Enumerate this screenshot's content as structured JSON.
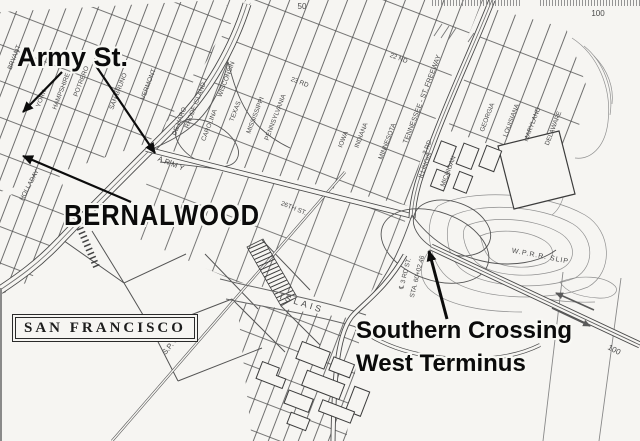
{
  "annotations": {
    "army_st": "Army St.",
    "bernalwood": "BERNALWOOD",
    "san_francisco": "SAN FRANCISCO",
    "southern_crossing_line1": "Southern Crossing",
    "southern_crossing_line2": "West Terminus"
  },
  "map": {
    "street_labels": [
      {
        "t": "BRYANT",
        "x": 16,
        "y": 58,
        "r": -69
      },
      {
        "t": "YORK",
        "x": 43,
        "y": 99,
        "r": -69
      },
      {
        "t": "HAMPSHIRE",
        "x": 63,
        "y": 92,
        "r": -69
      },
      {
        "t": "POTRERO",
        "x": 83,
        "y": 82,
        "r": -69
      },
      {
        "t": "SAN BRUNO",
        "x": 120,
        "y": 92,
        "r": -69
      },
      {
        "t": "VERMONT",
        "x": 150,
        "y": 85,
        "r": -69
      },
      {
        "t": "DE HARO",
        "x": 181,
        "y": 122,
        "r": -69
      },
      {
        "t": "RHODE ISLAND",
        "x": 197,
        "y": 106,
        "r": -69
      },
      {
        "t": "CAROLINA",
        "x": 211,
        "y": 126,
        "r": -69
      },
      {
        "t": "WISCONSIN",
        "x": 228,
        "y": 80,
        "r": -69
      },
      {
        "t": "HOLLADAY",
        "x": 31,
        "y": 186,
        "r": -62
      },
      {
        "t": "23 RD",
        "x": 299,
        "y": 84,
        "r": 21
      },
      {
        "t": "22 ND",
        "x": 398,
        "y": 60,
        "r": 21
      },
      {
        "t": "TEXAS",
        "x": 237,
        "y": 112,
        "r": -69
      },
      {
        "t": "MISSISSIPPI",
        "x": 257,
        "y": 116,
        "r": -69
      },
      {
        "t": "PENNSYLVANIA",
        "x": 277,
        "y": 118,
        "r": -69
      },
      {
        "t": "IOWA",
        "x": 345,
        "y": 140,
        "r": -69
      },
      {
        "t": "INDIANA",
        "x": 363,
        "y": 136,
        "r": -69
      },
      {
        "t": "MINNESOTA",
        "x": 389,
        "y": 142,
        "r": -69
      },
      {
        "t": "TENNESSEE - ST. FREEWAY",
        "x": 424,
        "y": 100,
        "r": -69,
        "s": 7
      },
      {
        "t": "3 RD",
        "x": 429,
        "y": 148,
        "r": -69
      },
      {
        "t": "ARMY",
        "x": 171,
        "y": 166,
        "r": 22,
        "ls": 2,
        "s": 7.5
      },
      {
        "t": "26TH ST.",
        "x": 293,
        "y": 210,
        "r": 22
      },
      {
        "t": "ILLINOIS",
        "x": 427,
        "y": 166,
        "r": -69
      },
      {
        "t": "MICHIGAN",
        "x": 450,
        "y": 172,
        "r": -69
      },
      {
        "t": "GEORGIA",
        "x": 489,
        "y": 118,
        "r": -69
      },
      {
        "t": "LOUISIANA",
        "x": 513,
        "y": 121,
        "r": -69
      },
      {
        "t": "MARYLAND",
        "x": 534,
        "y": 125,
        "r": -69
      },
      {
        "t": "DELAWARE",
        "x": 555,
        "y": 129,
        "r": -69
      },
      {
        "t": "ISLAIS",
        "x": 301,
        "y": 306,
        "r": 18,
        "s": 9,
        "ls": 3
      },
      {
        "t": "℄ 3 RD ST.",
        "x": 407,
        "y": 274,
        "r": -76
      },
      {
        "t": "STA. 60+02.46",
        "x": 419,
        "y": 277,
        "r": -76
      },
      {
        "t": "W.P.R.R. SLIP",
        "x": 540,
        "y": 258,
        "r": 11,
        "s": 7,
        "ls": 1
      },
      {
        "t": "S.P. CO",
        "x": 174,
        "y": 345,
        "r": -50,
        "s": 7.5
      },
      {
        "t": "50",
        "x": 302,
        "y": 9,
        "r": 0,
        "s": 8,
        "c": "#7a7a7a"
      },
      {
        "t": "100",
        "x": 598,
        "y": 16,
        "r": 0,
        "s": 8,
        "c": "#8a8a8a"
      },
      {
        "t": "100",
        "x": 613,
        "y": 352,
        "r": 28,
        "s": 8,
        "c": "#666666"
      }
    ],
    "arrows": [
      {
        "x1": 62,
        "y1": 72,
        "x2": 23,
        "y2": 112,
        "w": 2.2
      },
      {
        "x1": 96,
        "y1": 66,
        "x2": 155,
        "y2": 153,
        "w": 2.2
      },
      {
        "x1": 131,
        "y1": 202,
        "x2": 23,
        "y2": 156,
        "w": 2.2
      },
      {
        "x1": 447,
        "y1": 319,
        "x2": 429,
        "y2": 251,
        "w": 3
      }
    ],
    "colors": {
      "paper": "#f6f5f2",
      "ink": "#4a4a4a",
      "contour": "#909090",
      "annotation": "#0b0b0b",
      "halo": "#f8f8f4"
    }
  }
}
